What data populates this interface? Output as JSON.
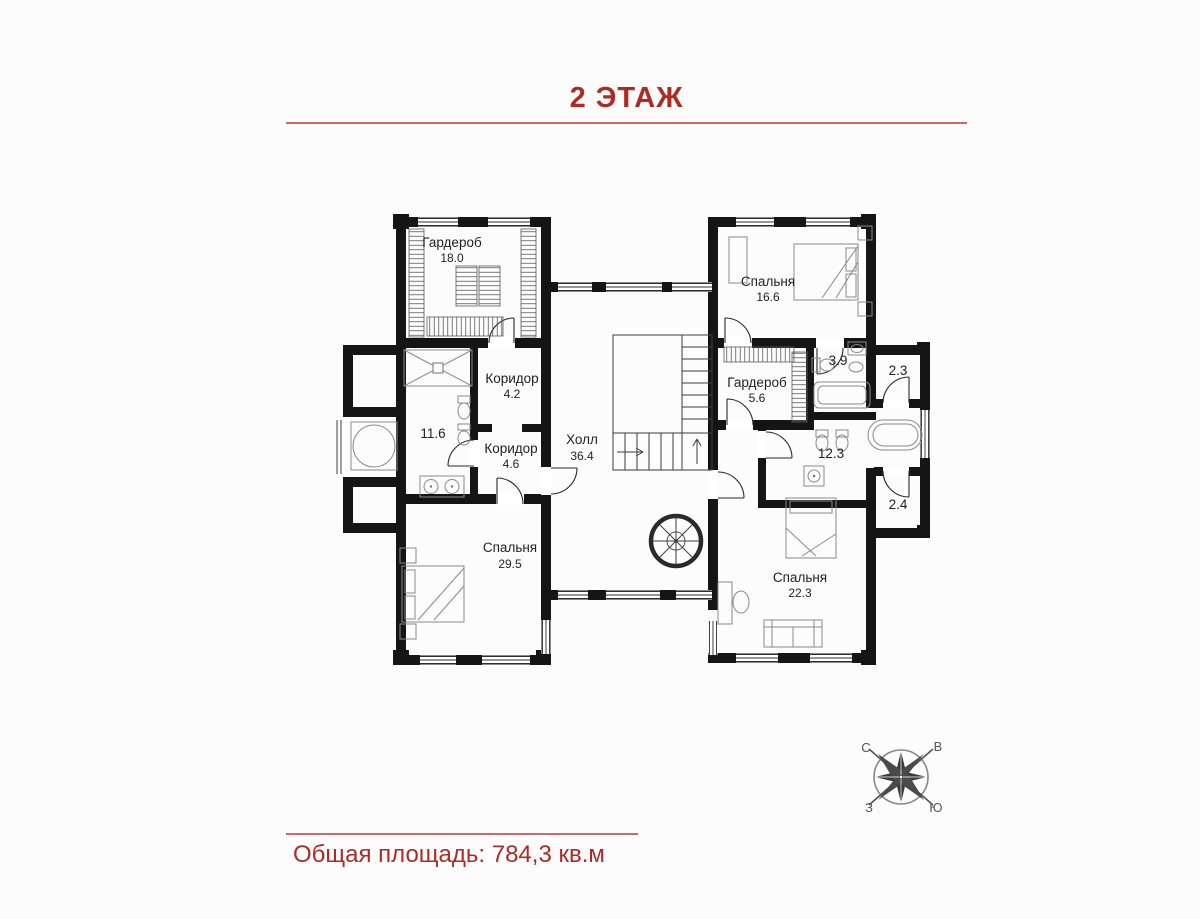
{
  "header": {
    "title": "2 ЭТАЖ"
  },
  "footer": {
    "total_area_label": "Общая площадь: 784,3 кв.м"
  },
  "colors": {
    "accent_red": "#ac2b24",
    "rule_red": "#c0504d",
    "wall_black": "#151515"
  },
  "floor_plan": {
    "rooms": [
      {
        "id": "wardrobe-top-left",
        "name": "Гардероб",
        "area": "18.0"
      },
      {
        "id": "bedroom-top-right",
        "name": "Спальня",
        "area": "16.6"
      },
      {
        "id": "corridor-upper",
        "name": "Коридор",
        "area": "4.2"
      },
      {
        "id": "bathroom-left",
        "name": "",
        "area": "11.6"
      },
      {
        "id": "corridor-lower",
        "name": "Коридор",
        "area": "4.6"
      },
      {
        "id": "hall",
        "name": "Холл",
        "area": "36.4"
      },
      {
        "id": "wardrobe-right",
        "name": "Гардероб",
        "area": "5.6"
      },
      {
        "id": "bathroom-small-right",
        "name": "",
        "area": "3.9"
      },
      {
        "id": "closet-right-upper",
        "name": "",
        "area": "2.3"
      },
      {
        "id": "bathroom-right",
        "name": "",
        "area": "12.3"
      },
      {
        "id": "closet-right-lower",
        "name": "",
        "area": "2.4"
      },
      {
        "id": "bedroom-bottom-left",
        "name": "Спальня",
        "area": "29.5"
      },
      {
        "id": "bedroom-bottom-right",
        "name": "Спальня",
        "area": "22.3"
      }
    ]
  },
  "compass": {
    "north": "С",
    "east": "В",
    "west": "З",
    "south": "Ю"
  }
}
